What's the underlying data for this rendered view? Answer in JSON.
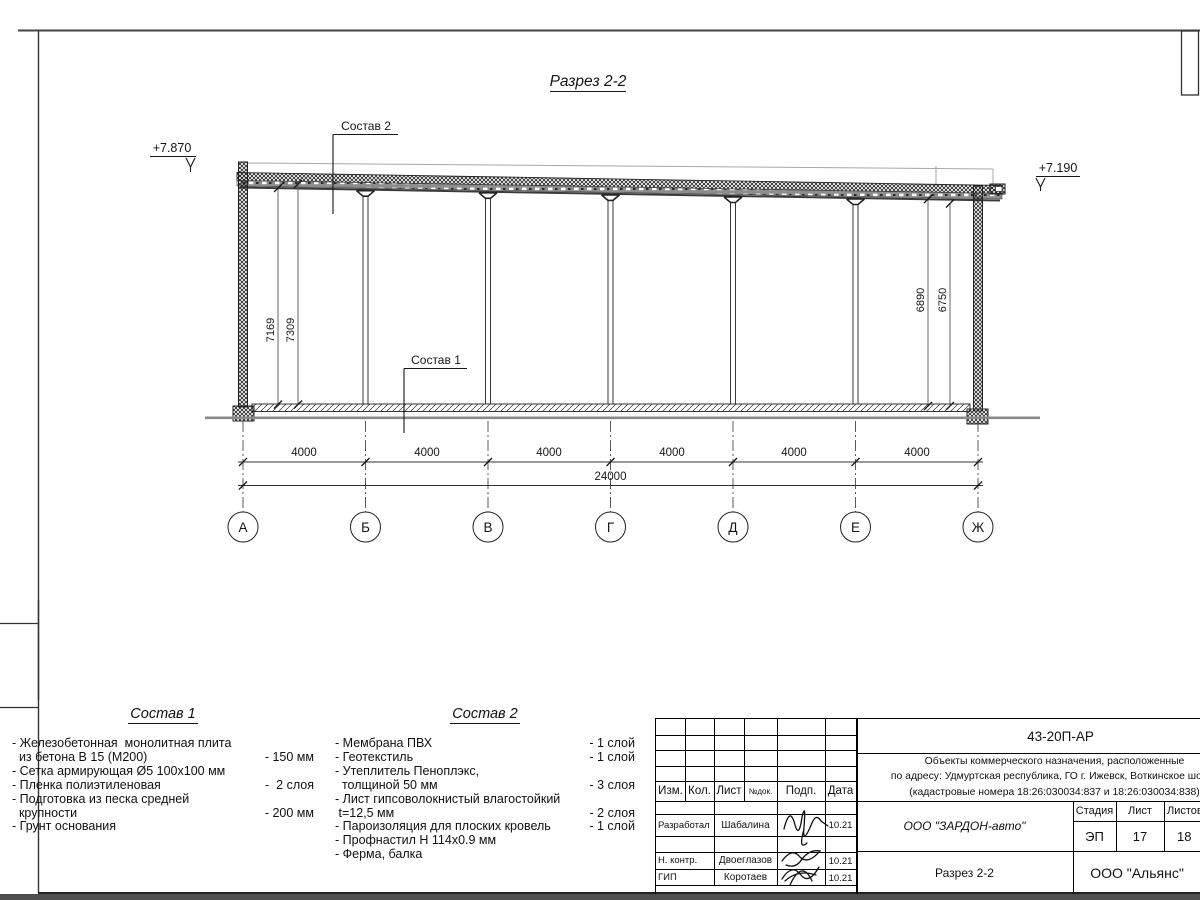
{
  "sheet": {
    "title": "Разрез 2-2",
    "elevation_left": "+7.870",
    "elevation_right": "+7.190",
    "leader1": "Состав 1",
    "leader2": "Состав 2",
    "dims": {
      "left_inner": "7169",
      "left_outer": "7309",
      "right_inner": "6890",
      "right_outer": "6750",
      "bays": [
        "4000",
        "4000",
        "4000",
        "4000",
        "4000",
        "4000"
      ],
      "total": "24000"
    },
    "axes": [
      "А",
      "Б",
      "В",
      "Г",
      "Д",
      "Е",
      "Ж"
    ]
  },
  "composition1": {
    "title": "Состав 1",
    "rows": [
      {
        "text": "- Железобетонная  монолитная плита",
        "qty": ""
      },
      {
        "text": "  из бетона В 15 (М200)",
        "qty": "- 150 мм"
      },
      {
        "text": "- Сетка армирующая Ø5 100х100 мм",
        "qty": ""
      },
      {
        "text": "- Пленка полиэтиленовая",
        "qty": "-  2 слоя"
      },
      {
        "text": "- Подготовка из песка средней",
        "qty": ""
      },
      {
        "text": "  крупности",
        "qty": "- 200 мм"
      },
      {
        "text": "- Грунт основания",
        "qty": ""
      }
    ]
  },
  "composition2": {
    "title": "Состав 2",
    "rows": [
      {
        "text": "- Мембрана ПВХ",
        "qty": "- 1 слой"
      },
      {
        "text": "- Геотекстиль",
        "qty": "- 1 слой"
      },
      {
        "text": "- Утеплитель Пеноплэкс,",
        "qty": ""
      },
      {
        "text": "  толщиной 50 мм",
        "qty": "- 3 слоя"
      },
      {
        "text": "- Лист гипсоволокнистый влагостойкий",
        "qty": ""
      },
      {
        "text": " t=12,5 мм",
        "qty": "- 2 слоя"
      },
      {
        "text": "- Пароизоляция для плоских кровель",
        "qty": "- 1 слой"
      },
      {
        "text": "- Профнастил Н 114х0.9 мм",
        "qty": ""
      },
      {
        "text": "- Ферма, балка",
        "qty": ""
      }
    ]
  },
  "titleblock": {
    "doc_code": "43-20П-АР",
    "project_lines": [
      "Объекты коммерческого назначения, расположенные",
      "по адресу: Удмуртская республика, ГО г. Ижевск, Воткинское шоссе",
      "(кадастровые номера 18:26:030034:837 и 18:26:030034:838)"
    ],
    "header": {
      "izm": "Изм.",
      "kol": "Кол.",
      "list": "Лист",
      "ndoc": "№док.",
      "podp": "Подп.",
      "data": "Дата"
    },
    "rows": [
      {
        "role": "Разработал",
        "name": "Шабалина",
        "date": "10.21"
      },
      {
        "role": "Н. контр.",
        "name": "Двоеглазов",
        "date": "10.21"
      },
      {
        "role": "ГИП",
        "name": "Коротаев",
        "date": "10.21"
      }
    ],
    "company": "ООО \"ЗАРДОН-авто\"",
    "stage_label": "Стадия",
    "sheet_label": "Лист",
    "sheets_label": "Листов",
    "stage": "ЭП",
    "sheet_no": "17",
    "sheets_total": "18",
    "drawing_name": "Разрез 2-2",
    "contractor": "ООО \"Альянс\""
  }
}
